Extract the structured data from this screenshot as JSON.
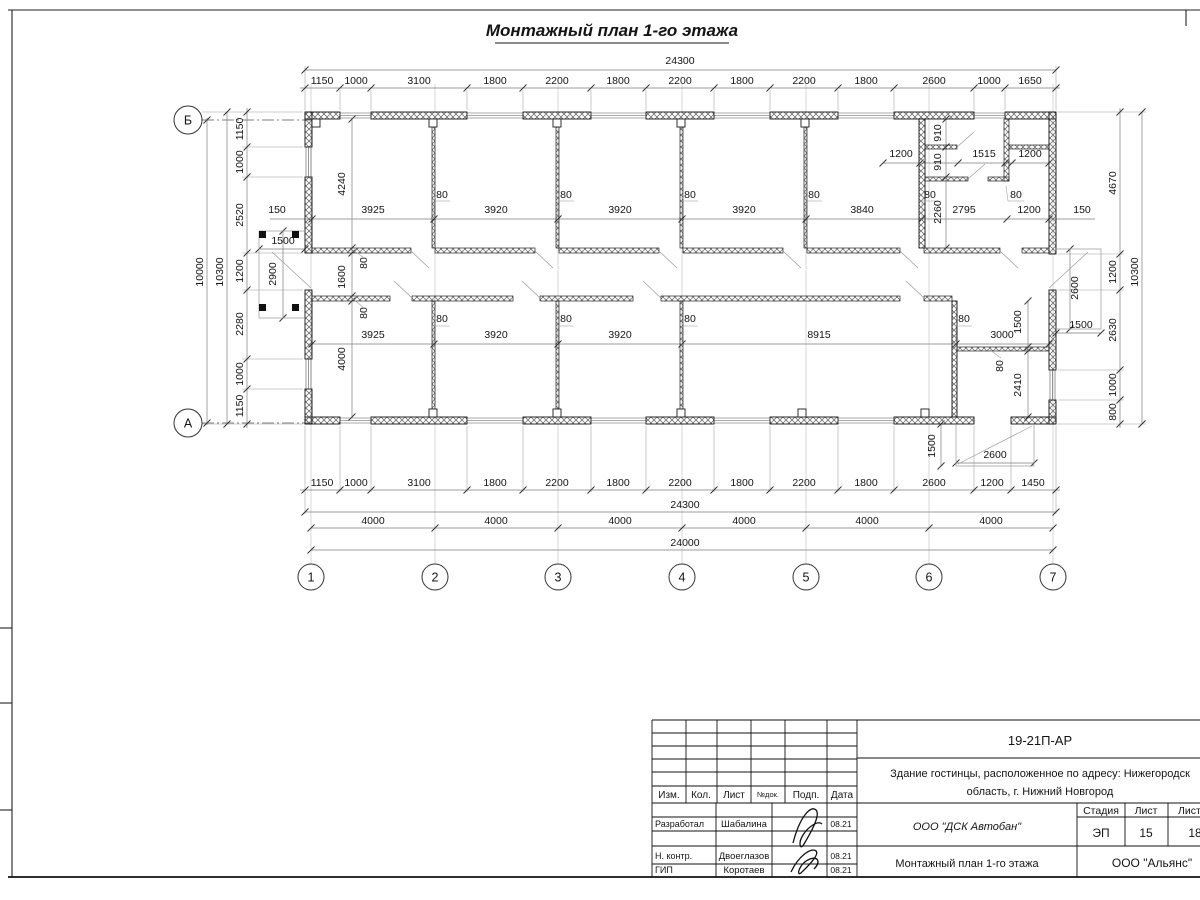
{
  "page": {
    "title": "Монтажный план 1-го этажа"
  },
  "dims": {
    "top_total": "24300",
    "top": [
      "1150",
      "1000",
      "3100",
      "1800",
      "2200",
      "1800",
      "2200",
      "1800",
      "2200",
      "1800",
      "2600",
      "1000",
      "1650"
    ],
    "bottom": [
      "1150",
      "1000",
      "3100",
      "1800",
      "2200",
      "1800",
      "2200",
      "1800",
      "2200",
      "1800",
      "2600",
      "1200",
      "1450"
    ],
    "bottom_total": "24300",
    "axes_span": [
      "4000",
      "4000",
      "4000",
      "4000",
      "4000",
      "4000"
    ],
    "axes_total": "24000",
    "left": [
      "1150",
      "1000",
      "2520",
      "1200",
      "2280",
      "1000",
      "1150"
    ],
    "left_total": "10300",
    "left_axes_total": "10000",
    "right": [
      "4670",
      "1200",
      "2630",
      "1000",
      "800"
    ],
    "right_total": "10300",
    "upper_row": [
      "3925",
      "3920",
      "3920",
      "3920",
      "3840",
      "2795",
      "1200"
    ],
    "upper_thk": [
      "80",
      "80",
      "80",
      "80",
      "80",
      "80"
    ],
    "lower_row": [
      "3925",
      "3920",
      "3920",
      "8915",
      "3000"
    ],
    "lower_thk": [
      "80",
      "80",
      "80",
      "80"
    ],
    "room_depth_upper": "4240",
    "corridor_w": "1600",
    "corridor_thk": [
      "80",
      "80"
    ],
    "room_depth_lower": "4000",
    "offsets": {
      "left": "150",
      "right": "150"
    },
    "tr": {
      "w1": "1200",
      "w2": "1515",
      "w3": "1200",
      "h1": "910",
      "h2": "910",
      "depth": "2260"
    },
    "br": {
      "h1": "1500",
      "thk": "80",
      "h2": "2410"
    },
    "porch_left": {
      "w": "1500",
      "d": "2900"
    },
    "porch_right": {
      "d": "2600",
      "w": "1500"
    },
    "porch_bottom": {
      "d": "1500",
      "w": "2600"
    }
  },
  "axis": {
    "letters": [
      "Б",
      "А"
    ],
    "numbers": [
      "1",
      "2",
      "3",
      "4",
      "5",
      "6",
      "7"
    ]
  },
  "titleblock": {
    "doc_number": "19-21П-АР",
    "object_line1": "Здание гостинцы, расположенное по адресу: Нижегородск",
    "object_line2": "область, г. Нижний Новгород",
    "cols": {
      "izm": "Изм.",
      "kol": "Кол.",
      "list": "Лист",
      "ndoc": "№док.",
      "podp": "Подп.",
      "data": "Дата"
    },
    "rows": [
      {
        "role": "Разработал",
        "name": "Шабалина",
        "date": "08.21"
      },
      {
        "role": "Н. контр.",
        "name": "Двоеглазов",
        "date": "08.21"
      },
      {
        "role": "ГИП",
        "name": "Коротаев",
        "date": "08.21"
      }
    ],
    "stage_label": "Стадия",
    "sheet_label": "Лист",
    "sheets_label": "Листов",
    "stage": "ЭП",
    "sheet": "15",
    "sheets": "18",
    "company": "ООО \"ДСК Автобан\"",
    "drawing_name": "Монтажный план 1-го этажа",
    "org": "ООО \"Альянс\""
  }
}
